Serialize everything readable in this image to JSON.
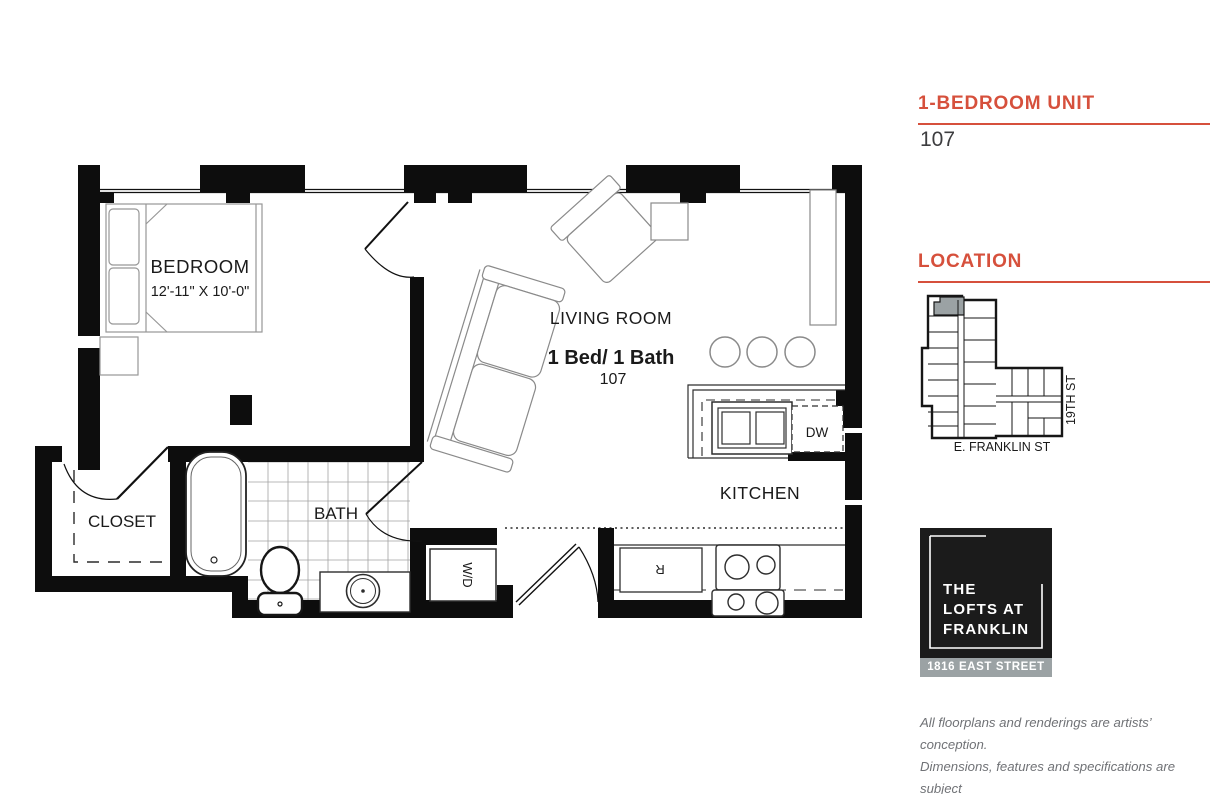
{
  "unit": {
    "type_label": "1-BEDROOM UNIT",
    "number": "107"
  },
  "location": {
    "heading": "LOCATION",
    "street_bottom": "E. FRANKLIN ST",
    "street_right": "19TH ST"
  },
  "floorplan": {
    "bedroom_label": "BEDROOM",
    "bedroom_dims": "12'-11\" X 10'-0\"",
    "living_room_label": "LIVING ROOM",
    "unit_summary": "1 Bed/ 1 Bath",
    "unit_number": "107",
    "kitchen_label": "KITCHEN",
    "bath_label": "BATH",
    "closet_label": "CLOSET",
    "washer_dryer_label": "W/D",
    "dishwasher_label": "DW",
    "refrigerator_label": "R"
  },
  "logo": {
    "line1": "THE",
    "line2": "LOFTS AT",
    "line3": "FRANKLIN",
    "address": "1816 EAST STREET"
  },
  "disclaimer": {
    "line1": "All floorplans and renderings are artists’ conception.",
    "line2": "Dimensions, features and specifications are subject",
    "line3": "to change at the discretion of the builder."
  },
  "colors": {
    "accent": "#d6503c",
    "logo_bg": "#1b1b1b",
    "gray_bar": "#9ba2a4",
    "highlight_unit": "#9ba2a4",
    "wall": "#0d0d0d"
  }
}
